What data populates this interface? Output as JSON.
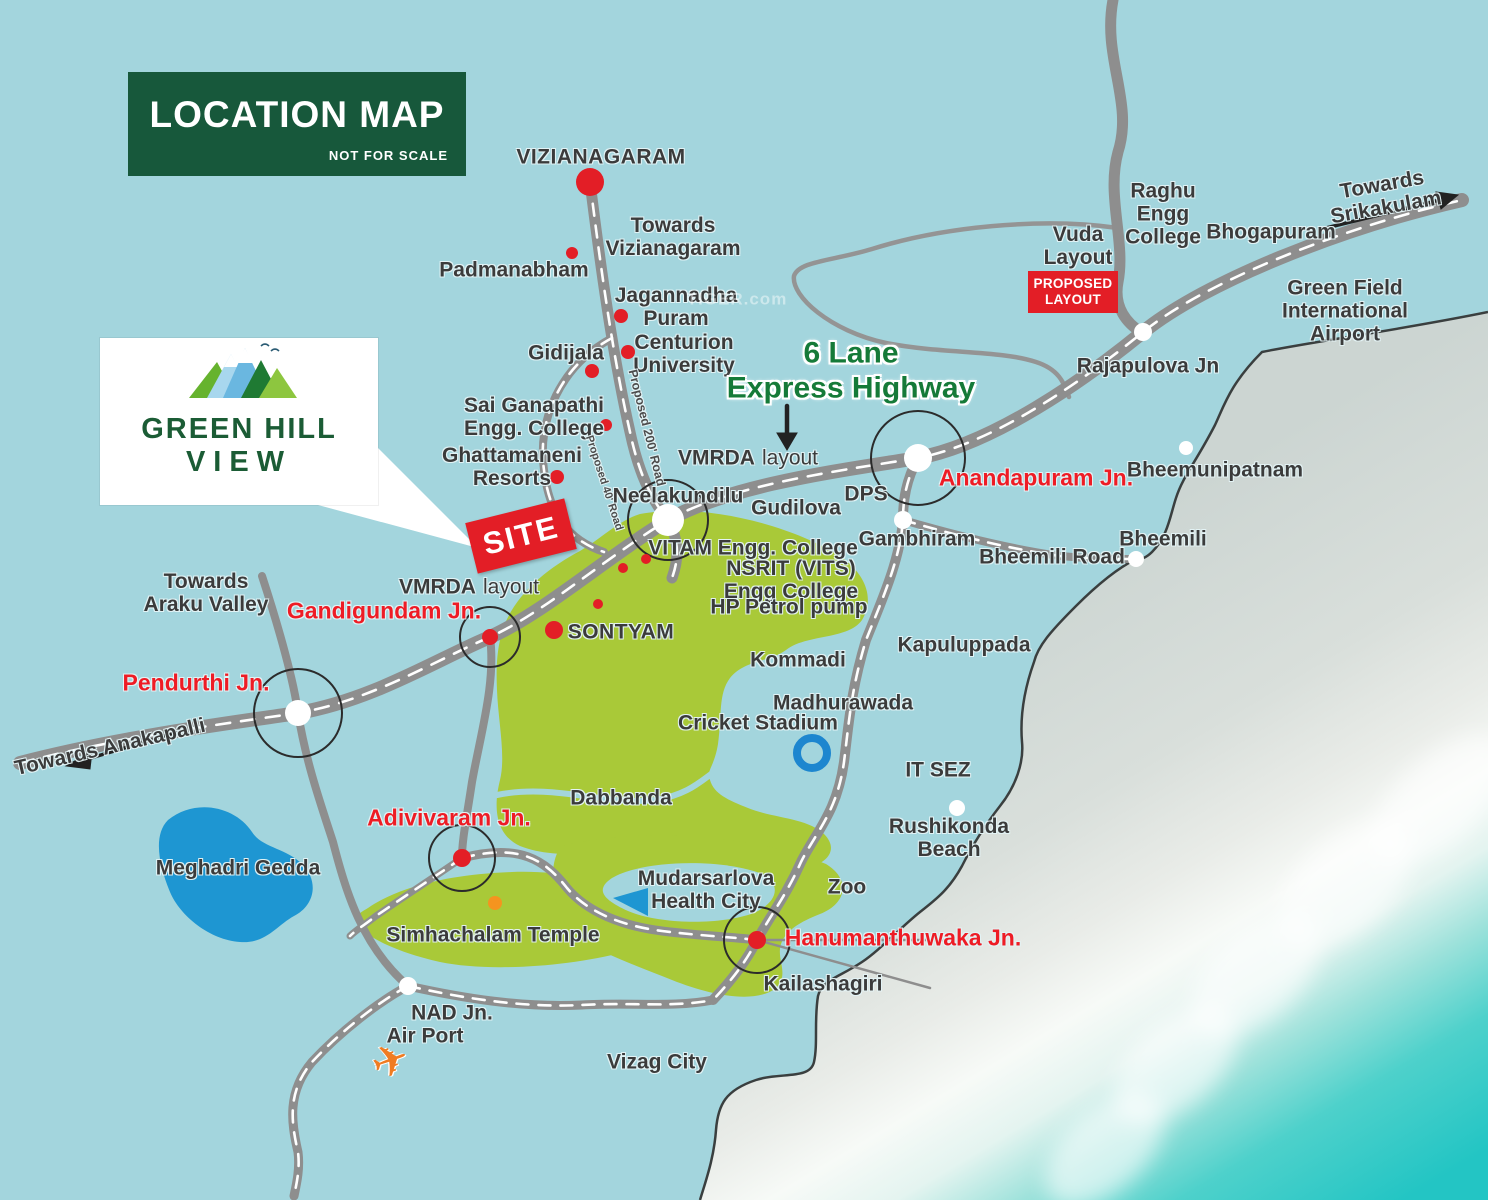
{
  "header": {
    "title": "LOCATION MAP",
    "subtitle": "NOT FOR SCALE"
  },
  "logo": {
    "name_line1": "GREEN HILL",
    "name_line2": "VIEW"
  },
  "site": {
    "label": "SITE"
  },
  "boxes": {
    "proposed_layout": "PROPOSED\nLAYOUT"
  },
  "watermark": "TIGER.com",
  "colors": {
    "land": "#a3d5dd",
    "road": "#8e8e8e",
    "green_area": "#a9c938",
    "accent_red": "#e31e26",
    "red_text": "#ee1c25",
    "green_text": "#157a38",
    "header_bg": "#17583b",
    "lake_blue": "#1e96d2",
    "sea_turquoise": "#2cc8c6",
    "beach": "#ccd5d2",
    "coastline": "#3a3f3f",
    "stadium_ring": "#1d86cf",
    "orange_dot": "#f5941f"
  },
  "labels": {
    "vizianagaram": "VIZIANAGARAM",
    "towards_vizianagaram_nw": "Towards\nVizianagaram",
    "padmanabham": "Padmanabham",
    "jagannadha_puram": "Jagannadha\nPuram",
    "gidijala": "Gidijala",
    "centurion_university": "Centurion\nUniversity",
    "sai_ganapathi": "Sai Ganapathi\nEngg. College",
    "ghattamaneni": "Ghattamaneni\nResorts",
    "proposed_200_road": "Proposed 200' Road",
    "proposed_40_road": "Proposed 40' Road",
    "vmrda_bold": "VMRDA",
    "vmrda_rest": "layout",
    "six_lane": "6 Lane\nExpress Highway",
    "neelakundilu": "Neelakundilu",
    "gudilova": "Gudilova",
    "dps": "DPS",
    "vitam": "VITAM Engg. College",
    "nsrit": "NSRIT (VITS)\nEngg College",
    "hp_petrol": "HP Petrol pump",
    "sontyam": "SONTYAM",
    "anandapuram_jn": "Anandapuram Jn.",
    "rajapulova_jn": "Rajapulova Jn",
    "vuda_layout": "Vuda\nLayout",
    "raghu_engg": "Raghu\nEngg\nCollege",
    "bhogapuram": "Bhogapuram",
    "towards_srikakulam": "Towards\nSrikakulam",
    "green_field_airport": "Green Field\nInternational\nAirport",
    "bheemunipatnam": "Bheemunipatnam",
    "bheemili_road": "Bheemili Road",
    "bheemili": "Bheemili",
    "gambhiram": "Gambhiram",
    "kommadi": "Kommadi",
    "kapuluppada": "Kapuluppada",
    "madhurawada": "Madhurawada",
    "cricket_stadium": "Cricket Stadium",
    "it_sez": "IT SEZ",
    "rushikonda_beach": "Rushikonda\nBeach",
    "zoo": "Zoo",
    "towards_araku": "Towards\nAraku Valley",
    "gandigundam_jn": "Gandigundam Jn.",
    "pendurthi_jn": "Pendurthi Jn.",
    "towards_anakapalli": "Towards Anakapalli",
    "meghadri_gedda": "Meghadri Gedda",
    "adivivaram_jn": "Adivivaram Jn.",
    "simhachalam_temple": "Simhachalam Temple",
    "dabbanda": "Dabbanda",
    "mudarsarlova": "Mudarsarlova\nHealth City",
    "hanumanthuwaka_jn": "Hanumanthuwaka Jn.",
    "kailashagiri": "Kailashagiri",
    "nad_jn": "NAD Jn.",
    "air_port": "Air Port",
    "vizag_city": "Vizag City"
  }
}
